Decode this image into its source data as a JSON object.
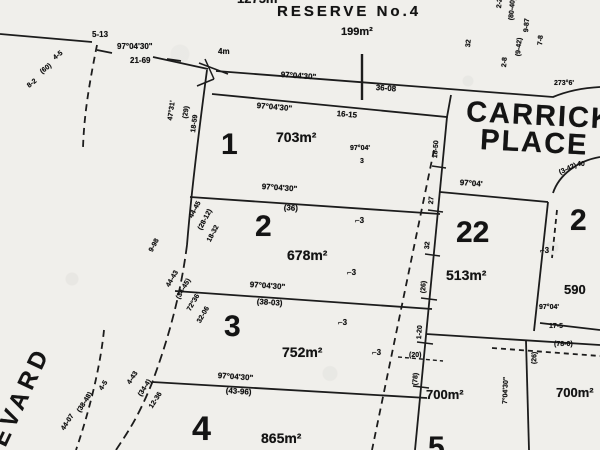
{
  "plan": {
    "reserve_name": "RESERVE No.4",
    "reserve_area": "199m²",
    "street_left": "EVARD",
    "street_right": [
      "CARRICK",
      "PLACE"
    ],
    "ink_color": "#1c1c1c",
    "paper_color": "#f0efeb",
    "lots": [
      {
        "number": "1",
        "area": "703m²"
      },
      {
        "number": "2",
        "area": "678m²"
      },
      {
        "number": "3",
        "area": "752m²"
      },
      {
        "number": "4",
        "area": "865m²"
      },
      {
        "number": "22",
        "area": "513m²"
      },
      {
        "number": "2",
        "area": "590"
      },
      {
        "number": "5",
        "area": ""
      },
      {
        "number": "",
        "area": "700m²"
      },
      {
        "number": "",
        "area": "700m²"
      },
      {
        "number": "",
        "area": "1275m²"
      }
    ]
  },
  "labels": [
    {
      "name": "area-1275",
      "text": "1275m²",
      "x": 237,
      "y": -8,
      "size": 13
    },
    {
      "name": "reserve-name",
      "text": "RESERVE No.4",
      "x": 277,
      "y": 4,
      "size": 15,
      "spacing": 3
    },
    {
      "name": "reserve-area",
      "text": "199m²",
      "x": 341,
      "y": 27,
      "size": 11
    },
    {
      "name": "dim-corner-nw",
      "text": "5-13",
      "x": 92,
      "y": 31,
      "size": 8
    },
    {
      "name": "bearing-nw",
      "text": "97°04'30\"",
      "x": 117,
      "y": 43,
      "size": 8
    },
    {
      "name": "dist-nw",
      "text": "21-69",
      "x": 130,
      "y": 57,
      "size": 8
    },
    {
      "name": "dim-4m",
      "text": "4m",
      "x": 218,
      "y": 48,
      "size": 8
    },
    {
      "name": "bearing-reserve-edge",
      "text": "97°04'30\"",
      "x": 281,
      "y": 71,
      "size": 8,
      "rot": 4
    },
    {
      "name": "dist-reserve-edge",
      "text": "36-08",
      "x": 376,
      "y": 84,
      "size": 8,
      "rot": 4
    },
    {
      "name": "bearing-lot1-top",
      "text": "97°04'30\"",
      "x": 257,
      "y": 102,
      "size": 8,
      "rot": 5
    },
    {
      "name": "dist-lot1-top",
      "text": "16-15",
      "x": 337,
      "y": 110,
      "size": 8,
      "rot": 5
    },
    {
      "name": "lot1-number",
      "text": "1",
      "x": 221,
      "y": 130,
      "size": 30
    },
    {
      "name": "lot1-area",
      "text": "703m²",
      "x": 276,
      "y": 130,
      "size": 14
    },
    {
      "name": "bearing-lot1-inner",
      "text": "97°04'",
      "x": 350,
      "y": 145,
      "size": 7
    },
    {
      "name": "dist-lot1-inner",
      "text": "3",
      "x": 360,
      "y": 158,
      "size": 7
    },
    {
      "name": "street-carrick-line1",
      "text": "CARRICK",
      "x": 467,
      "y": 98,
      "size": 29,
      "rot": 3,
      "spacing": 2
    },
    {
      "name": "street-carrick-line2",
      "text": "PLACE",
      "x": 481,
      "y": 126,
      "size": 29,
      "rot": 3,
      "spacing": 2
    },
    {
      "name": "bearing-ne",
      "text": "273°6'",
      "x": 554,
      "y": 80,
      "size": 7
    },
    {
      "name": "bearing-lot12",
      "text": "97°04'30\"",
      "x": 262,
      "y": 183,
      "size": 8,
      "rot": 4
    },
    {
      "name": "dist-lot12",
      "text": "(36)",
      "x": 284,
      "y": 204,
      "size": 8,
      "rot": 4
    },
    {
      "name": "lot2-number",
      "text": "2",
      "x": 255,
      "y": 212,
      "size": 30
    },
    {
      "name": "lot2-area",
      "text": "678m²",
      "x": 287,
      "y": 248,
      "size": 14
    },
    {
      "name": "bearing-lot23",
      "text": "97°04'30\"",
      "x": 250,
      "y": 281,
      "size": 8,
      "rot": 4
    },
    {
      "name": "dist-lot23",
      "text": "(38-03)",
      "x": 257,
      "y": 298,
      "size": 8,
      "rot": 4
    },
    {
      "name": "lot3-number",
      "text": "3",
      "x": 224,
      "y": 312,
      "size": 30
    },
    {
      "name": "lot3-area",
      "text": "752m²",
      "x": 282,
      "y": 345,
      "size": 14
    },
    {
      "name": "bearing-lot34",
      "text": "97°04'30\"",
      "x": 218,
      "y": 372,
      "size": 8,
      "rot": 4
    },
    {
      "name": "dist-lot34",
      "text": "(43-96)",
      "x": 226,
      "y": 387,
      "size": 8,
      "rot": 4
    },
    {
      "name": "lot4-number",
      "text": "4",
      "x": 192,
      "y": 412,
      "size": 34
    },
    {
      "name": "lot4-area",
      "text": "865m²",
      "x": 261,
      "y": 431,
      "size": 14
    },
    {
      "name": "lot22-number",
      "text": "22",
      "x": 456,
      "y": 218,
      "size": 30
    },
    {
      "name": "lot22-area",
      "text": "513m²",
      "x": 446,
      "y": 268,
      "size": 14
    },
    {
      "name": "bearing-lot22-top",
      "text": "97°04'",
      "x": 460,
      "y": 179,
      "size": 8,
      "rot": 4
    },
    {
      "name": "lot21-number",
      "text": "2",
      "x": 570,
      "y": 206,
      "size": 30
    },
    {
      "name": "lot21-area",
      "text": "590",
      "x": 564,
      "y": 283,
      "size": 13
    },
    {
      "name": "area-700-left",
      "text": "700m²",
      "x": 426,
      "y": 388,
      "size": 13
    },
    {
      "name": "area-700-right",
      "text": "700m²",
      "x": 556,
      "y": 386,
      "size": 13
    },
    {
      "name": "lot5-number",
      "text": "5",
      "x": 428,
      "y": 433,
      "size": 30
    },
    {
      "name": "street-evard",
      "text": "EVARD",
      "x": -12,
      "y": 440,
      "size": 24,
      "rot": -65,
      "spacing": 5
    },
    {
      "name": "annot-ne-1",
      "text": "2-2",
      "x": 496,
      "y": 8,
      "size": 7,
      "rot": -85
    },
    {
      "name": "annot-ne-2",
      "text": "(80-40)",
      "x": 508,
      "y": 20,
      "size": 7,
      "rot": -85
    },
    {
      "name": "annot-ne-3",
      "text": "9-87",
      "x": 523,
      "y": 32,
      "size": 7,
      "rot": -85
    },
    {
      "name": "annot-ne-4",
      "text": "7-8",
      "x": 537,
      "y": 45,
      "size": 7,
      "rot": -85
    },
    {
      "name": "annot-ne-5",
      "text": "(9-42)",
      "x": 515,
      "y": 56,
      "size": 7,
      "rot": -85
    },
    {
      "name": "annot-ne-6",
      "text": "2-8",
      "x": 501,
      "y": 67,
      "size": 7,
      "rot": -85
    },
    {
      "name": "annot-ne-7",
      "text": "32",
      "x": 465,
      "y": 47,
      "size": 7,
      "rot": -85
    },
    {
      "name": "annot-nw-1",
      "text": "4-5",
      "x": 52,
      "y": 56,
      "size": 7,
      "rot": -38
    },
    {
      "name": "annot-nw-2",
      "text": "(60)",
      "x": 39,
      "y": 70,
      "size": 7,
      "rot": -38
    },
    {
      "name": "annot-nw-3",
      "text": "8-2",
      "x": 26,
      "y": 84,
      "size": 7,
      "rot": -38
    },
    {
      "name": "annot-west-1",
      "text": "47°31'",
      "x": 167,
      "y": 120,
      "size": 7,
      "rot": -82
    },
    {
      "name": "annot-west-2",
      "text": "(29)",
      "x": 182,
      "y": 118,
      "size": 7,
      "rot": -82
    },
    {
      "name": "annot-west-3",
      "text": "18-59",
      "x": 190,
      "y": 132,
      "size": 7,
      "rot": -82
    },
    {
      "name": "annot-west-4",
      "text": "44-45",
      "x": 188,
      "y": 216,
      "size": 7,
      "rot": -62
    },
    {
      "name": "annot-west-5",
      "text": "(28-12)",
      "x": 197,
      "y": 228,
      "size": 7,
      "rot": -62
    },
    {
      "name": "annot-west-6",
      "text": "18-32",
      "x": 206,
      "y": 240,
      "size": 7,
      "rot": -62
    },
    {
      "name": "annot-west-7",
      "text": "9-98",
      "x": 148,
      "y": 250,
      "size": 7,
      "rot": -62
    },
    {
      "name": "annot-west-8",
      "text": "44-43",
      "x": 165,
      "y": 285,
      "size": 7,
      "rot": -60
    },
    {
      "name": "annot-west-9",
      "text": "(34-45)",
      "x": 175,
      "y": 297,
      "size": 7,
      "rot": -60
    },
    {
      "name": "annot-west-10",
      "text": "72°36'",
      "x": 186,
      "y": 309,
      "size": 7,
      "rot": -60
    },
    {
      "name": "annot-west-11",
      "text": "32-06",
      "x": 196,
      "y": 321,
      "size": 7,
      "rot": -60
    },
    {
      "name": "annot-west-12",
      "text": "4-43",
      "x": 126,
      "y": 382,
      "size": 7,
      "rot": -57
    },
    {
      "name": "annot-west-13",
      "text": "(34-4)",
      "x": 137,
      "y": 394,
      "size": 7,
      "rot": -57
    },
    {
      "name": "annot-west-14",
      "text": "12-36",
      "x": 148,
      "y": 406,
      "size": 7,
      "rot": -57
    },
    {
      "name": "annot-sw-1",
      "text": "4-5",
      "x": 98,
      "y": 388,
      "size": 7,
      "rot": -57
    },
    {
      "name": "annot-sw-2",
      "text": "(38-48)",
      "x": 76,
      "y": 410,
      "size": 7,
      "rot": -57
    },
    {
      "name": "annot-sw-3",
      "text": "44-07",
      "x": 60,
      "y": 428,
      "size": 7,
      "rot": -57
    },
    {
      "name": "annot-strip-1",
      "text": "18-50",
      "x": 432,
      "y": 158,
      "size": 7,
      "rot": -86
    },
    {
      "name": "annot-strip-2",
      "text": "27",
      "x": 428,
      "y": 204,
      "size": 7,
      "rot": -86
    },
    {
      "name": "annot-strip-3",
      "text": "32",
      "x": 424,
      "y": 249,
      "size": 7,
      "rot": -86
    },
    {
      "name": "annot-strip-4",
      "text": "(26)",
      "x": 420,
      "y": 293,
      "size": 7,
      "rot": -86
    },
    {
      "name": "annot-strip-5",
      "text": "1-20",
      "x": 416,
      "y": 339,
      "size": 7,
      "rot": -86
    },
    {
      "name": "annot-strip-6",
      "text": "(78)",
      "x": 412,
      "y": 385,
      "size": 7,
      "rot": -86
    },
    {
      "name": "easement-mark",
      "text": "⌐3",
      "x": 355,
      "y": 217,
      "size": 8
    },
    {
      "name": "easement-mark",
      "text": "⌐3",
      "x": 347,
      "y": 269,
      "size": 8
    },
    {
      "name": "easement-mark",
      "text": "⌐3",
      "x": 338,
      "y": 319,
      "size": 8
    },
    {
      "name": "easement-mark",
      "text": "⌐3",
      "x": 540,
      "y": 247,
      "size": 8
    },
    {
      "name": "easement-mark",
      "text": "⌐3",
      "x": 372,
      "y": 349,
      "size": 8
    },
    {
      "name": "bearing-east-1",
      "text": "97°04'",
      "x": 539,
      "y": 304,
      "size": 7
    },
    {
      "name": "dist-east-1",
      "text": "17-5",
      "x": 549,
      "y": 323,
      "size": 7
    },
    {
      "name": "dist-east-2",
      "text": "(78-0)",
      "x": 554,
      "y": 341,
      "size": 7
    },
    {
      "name": "dist-east-3",
      "text": "(20)",
      "x": 409,
      "y": 352,
      "size": 7
    },
    {
      "name": "bearing-south-1",
      "text": "7°04'30\"",
      "x": 502,
      "y": 404,
      "size": 7,
      "rot": -88
    },
    {
      "name": "dist-south-1",
      "text": "(26)",
      "x": 531,
      "y": 364,
      "size": 7,
      "rot": -88
    },
    {
      "name": "dim-curb-1",
      "text": "40",
      "x": 577,
      "y": 161,
      "size": 7
    },
    {
      "name": "dim-curb-2",
      "text": "(3-42)",
      "x": 558,
      "y": 170,
      "size": 7,
      "rot": -25
    }
  ]
}
